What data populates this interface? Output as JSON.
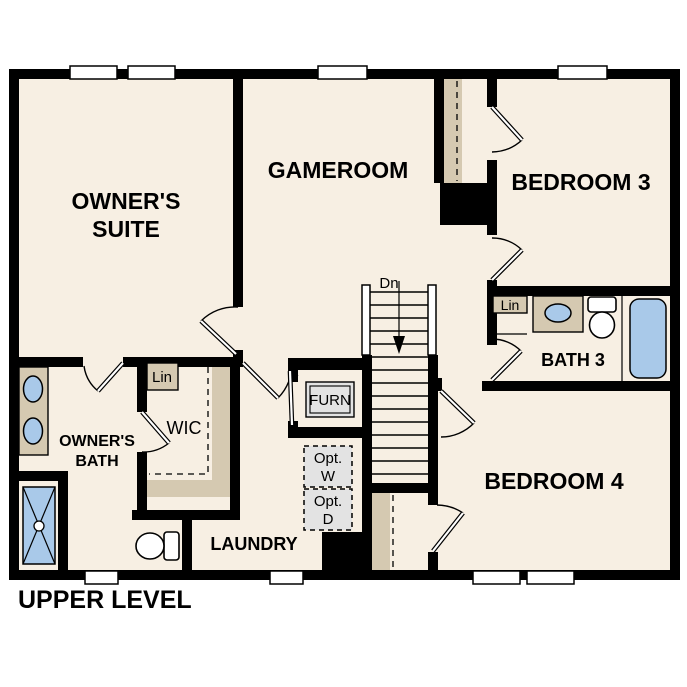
{
  "title": "UPPER LEVEL",
  "rooms": {
    "owners_suite": {
      "line1": "OWNER'S",
      "line2": "SUITE"
    },
    "gameroom": {
      "label": "GAMEROOM"
    },
    "bedroom3": {
      "label": "BEDROOM 3"
    },
    "bath3": {
      "label": "BATH 3"
    },
    "bedroom4": {
      "label": "BEDROOM 4"
    },
    "owners_bath": {
      "line1": "OWNER'S",
      "line2": "BATH"
    },
    "wic": {
      "label": "WIC"
    },
    "laundry": {
      "label": "LAUNDRY"
    }
  },
  "annotations": {
    "stair_direction": "Dn",
    "wic_linen": "Lin",
    "bath3_linen": "Lin",
    "furnace": "FURN",
    "opt_washer_line1": "Opt.",
    "opt_washer_line2": "W",
    "opt_dryer_line1": "Opt.",
    "opt_dryer_line2": "D"
  },
  "colors": {
    "wall": "#000000",
    "floor": "#f7efe3",
    "cabinet": "#d5c9b1",
    "fixture": "#a9c9e9",
    "optional": "#e3e3e3",
    "paper": "#ffffff"
  }
}
